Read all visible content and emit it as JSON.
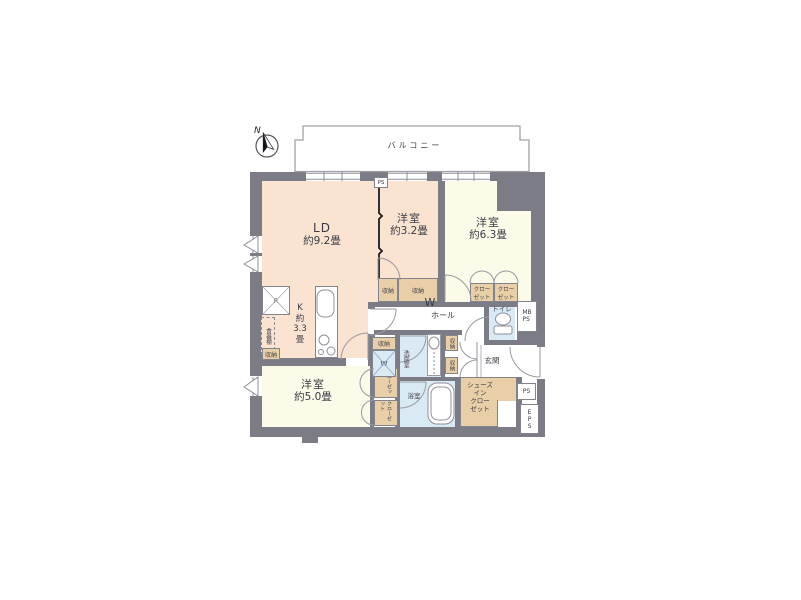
{
  "plan_title": "2LDK apartment floor plan",
  "colors": {
    "wall": "#7c7c86",
    "floor_living": "#fae3d0",
    "floor_bedroom": "#fcfae8",
    "floor_wet": "#d9eaf5",
    "storage": "#e8cfa8",
    "line": "#8f8f99",
    "text": "#3b3b44"
  },
  "compass": {
    "label": "N"
  },
  "balcony": {
    "label": "バルコニー"
  },
  "rooms": {
    "ld": {
      "name": "LD",
      "size": "約9.2畳"
    },
    "bedroom32": {
      "name": "洋室",
      "size": "約3.2畳"
    },
    "bedroom63": {
      "name": "洋室",
      "size": "約6.3畳"
    },
    "bedroom50": {
      "name": "洋室",
      "size": "約5.0畳"
    },
    "kitchen": {
      "label": "K\n約\n3.3\n畳"
    },
    "hall": {
      "label": "ホール"
    },
    "toilet": {
      "label": "トイレ"
    },
    "washroom": {
      "label": "洗面室"
    },
    "bathroom": {
      "label": "浴室"
    },
    "entrance": {
      "label": "玄関"
    }
  },
  "storage": {
    "storage_label": "収納",
    "closet_two_line": "クロー\nゼット",
    "closet_vertical": "クローゼット",
    "shoes_in_closet": "シューズ\nイン\nクロー\nゼット",
    "cupboard": "食器棚"
  },
  "utility": {
    "ps_top": "PS",
    "mb_ps": "MB\nPS",
    "ps_right": "PS",
    "eps": "EPS",
    "fridge": "R",
    "washer": "W",
    "hall_w": "W"
  }
}
